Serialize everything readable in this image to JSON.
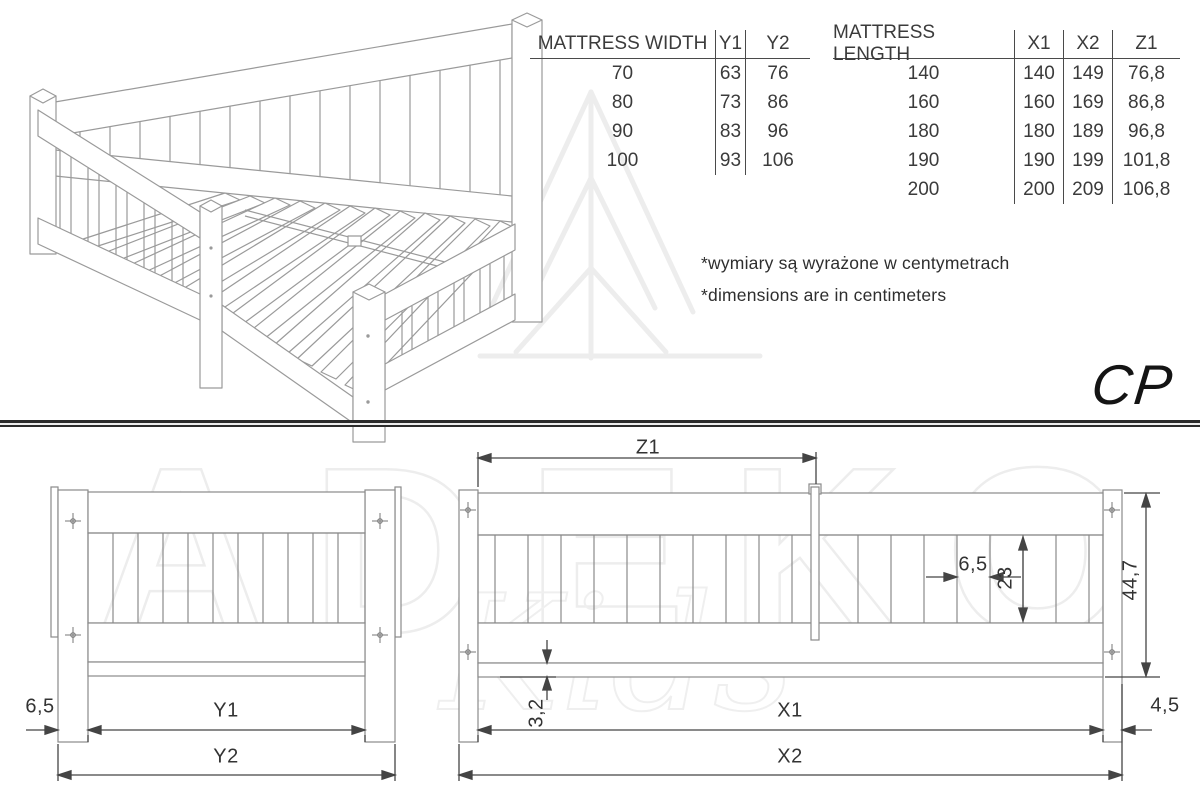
{
  "wt": {
    "h0": "MATTRESS WIDTH",
    "h1": "Y1",
    "h2": "Y2",
    "r": [
      [
        "70",
        "63",
        "76"
      ],
      [
        "80",
        "73",
        "86"
      ],
      [
        "90",
        "83",
        "96"
      ],
      [
        "100",
        "93",
        "106"
      ]
    ]
  },
  "lt": {
    "h0": "MATTRESS LENGTH",
    "h1": "X1",
    "h2": "X2",
    "h3": "Z1",
    "r": [
      [
        "140",
        "140",
        "149",
        "76,8"
      ],
      [
        "160",
        "160",
        "169",
        "86,8"
      ],
      [
        "180",
        "180",
        "189",
        "96,8"
      ],
      [
        "190",
        "190",
        "199",
        "101,8"
      ],
      [
        "200",
        "200",
        "209",
        "106,8"
      ]
    ]
  },
  "notes": {
    "pl": "*wymiary są wyrażone w centymetrach",
    "en": "*dimensions are in centimeters"
  },
  "logo": "CP",
  "wm": {
    "brand": "ADEKO",
    "sub": "Kids"
  },
  "dims": {
    "offset": "6,5",
    "y1": "Y1",
    "y2": "Y2",
    "z1": "Z1",
    "gap": "6,5",
    "slat": "23",
    "height": "44,7",
    "drop": "3,2",
    "x1": "X1",
    "post": "4,5",
    "x2": "X2"
  },
  "colors": {
    "furniture_line": "#8a8a8a",
    "dimension_line": "#444444",
    "text": "#3b3b3b",
    "divider": "#2b2b2b",
    "watermark": "#ededed"
  }
}
